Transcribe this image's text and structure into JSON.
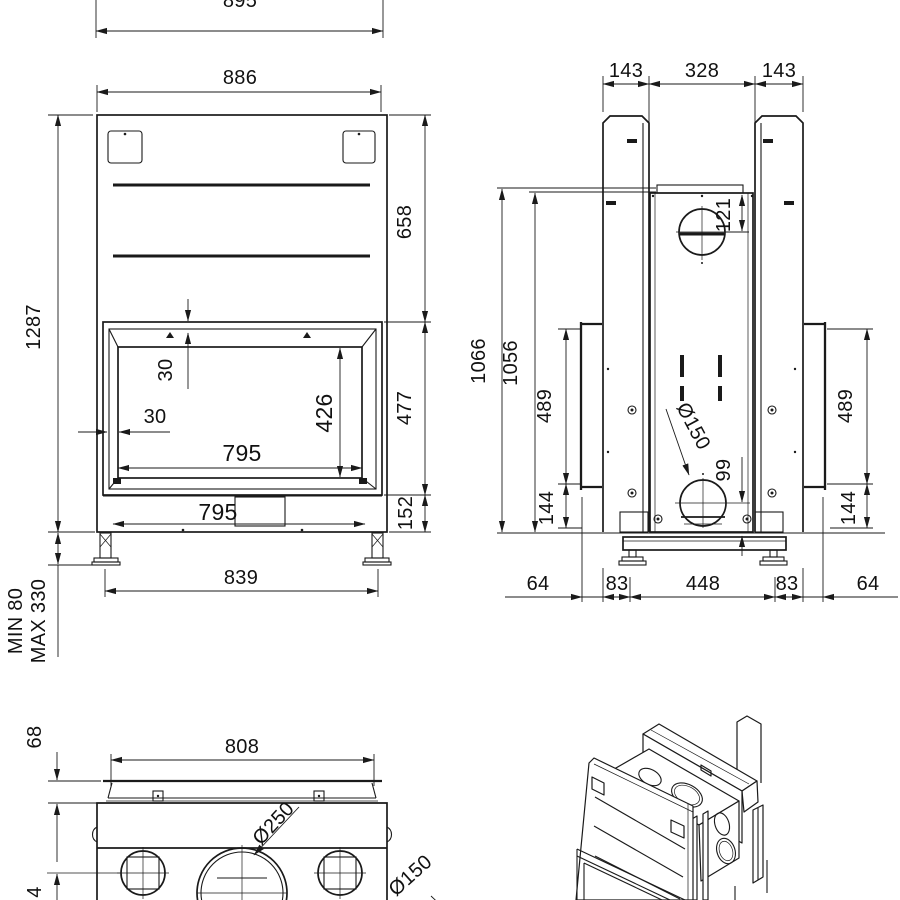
{
  "drawing": {
    "type": "technical-dimension-drawing",
    "subject": "fireplace-insert",
    "line_color": "#1a1a1a",
    "background": "#ffffff"
  },
  "dims": {
    "front": {
      "overall_width": "895",
      "width": "886",
      "height": "1287",
      "upper_height": "658",
      "opening_height": "477",
      "base_height": "152",
      "inset_top": "30",
      "inset_side": "30",
      "glass_width": "795",
      "base_width": "795",
      "glass_height": "426",
      "feet_spacing": "839",
      "leg_min": "MIN 80",
      "leg_max": "MAX 330"
    },
    "rear": {
      "duct_left": "143",
      "duct_center": "328",
      "duct_right": "143",
      "height_outer": "1066",
      "height_inner": "1056",
      "panel_left": "489",
      "panel_right": "489",
      "base_left": "144",
      "base_right": "144",
      "flue_offset": "121",
      "flue_diameter": "Ø150",
      "flue_height": "99",
      "chain": [
        "64",
        "83",
        "448",
        "83",
        "64"
      ]
    },
    "top": {
      "width": "808",
      "collar_height": "68",
      "outlet_center": "Ø250",
      "outlet_side": "Ø150",
      "partial_dim": "4"
    }
  }
}
